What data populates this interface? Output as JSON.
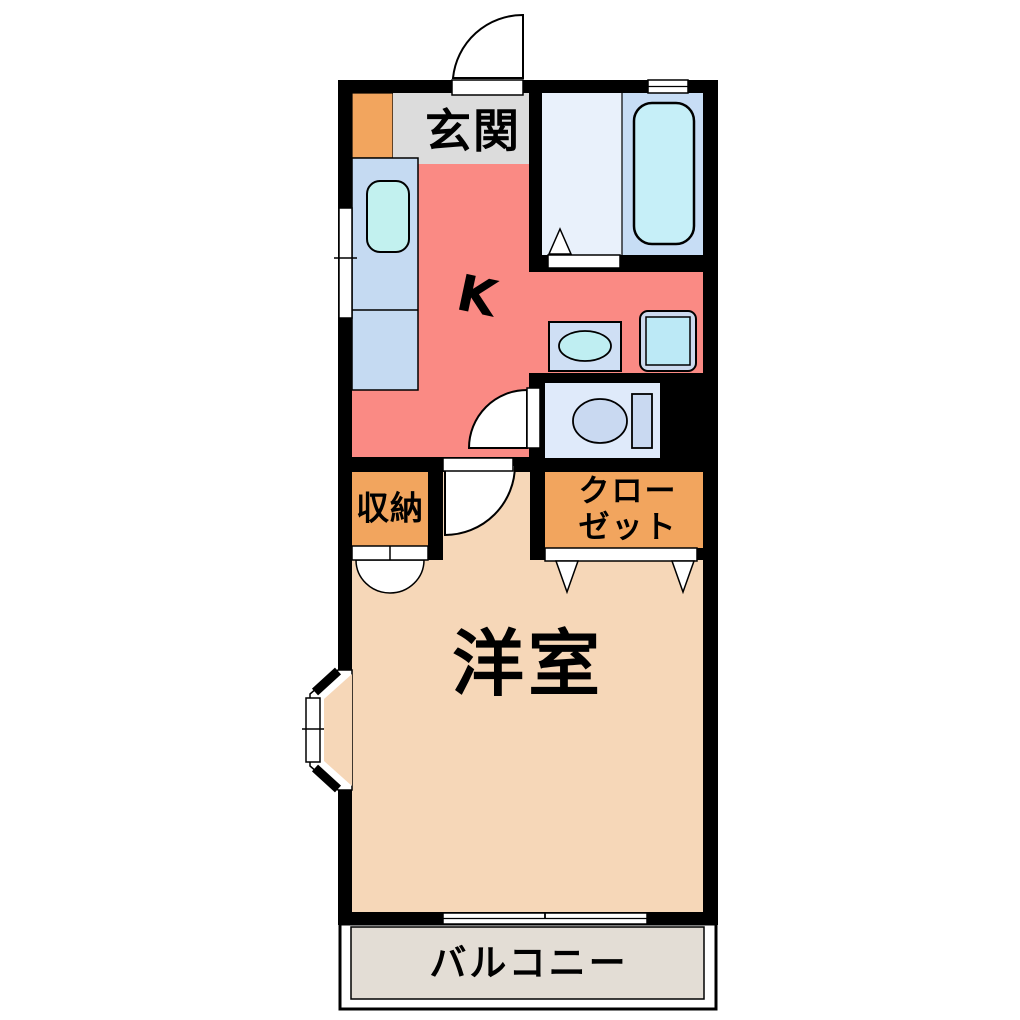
{
  "plan": {
    "type": "japanese-apartment-floor-plan",
    "labels": {
      "entrance": "玄関",
      "kitchen": "K",
      "storage": "収納",
      "closet_line1": "クロー",
      "closet_line2": "ゼット",
      "western_room": "洋室",
      "balcony": "バルコニー"
    },
    "colors": {
      "wall": "#000000",
      "background": "#ffffff",
      "entrance_floor": "#dcdcdc",
      "entrance_cabinet": "#f2a55e",
      "kitchen": "#fa8a84",
      "counter": "#c5daf2",
      "sink": "#c2f1ef",
      "bath_floor": "#e9f1fb",
      "bath_tub_zone": "#c7ddf5",
      "bathtub": "#c6eff8",
      "washbasin": "#cfdff4",
      "washbasin_bowl": "#bfeef2",
      "washer_frame": "#ccd9ee",
      "washer_drum": "#bce9f6",
      "toilet_room": "#dfeafa",
      "toilet_fixture": "#c9d9f1",
      "storage": "#f2a55e",
      "closet": "#f2a55e",
      "room": "#f6d7b8",
      "balcony": "#e3ddd5"
    }
  }
}
